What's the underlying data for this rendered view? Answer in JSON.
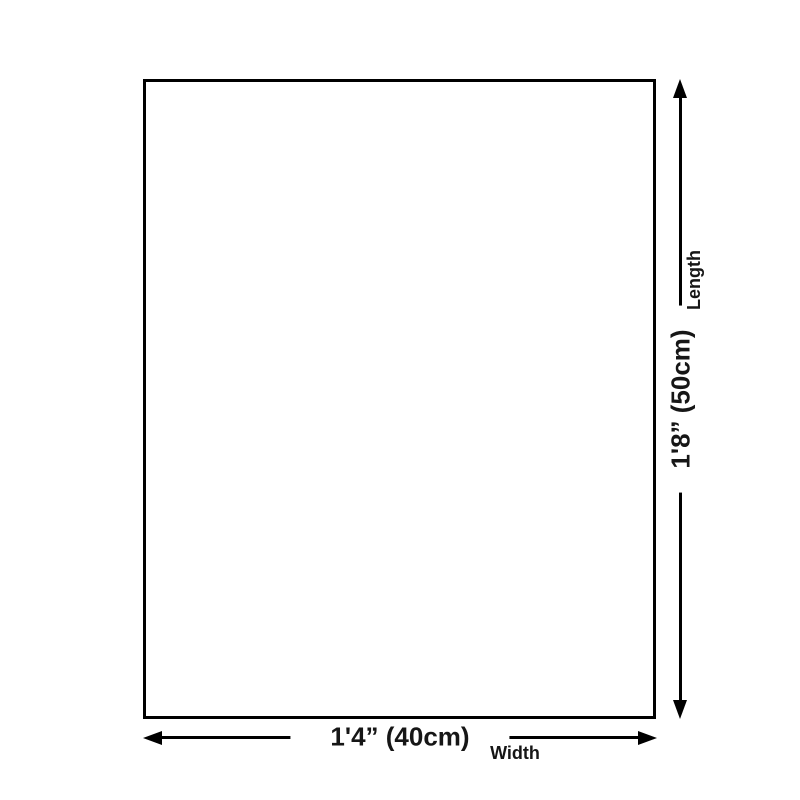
{
  "palette": {
    "background": "#ffffff",
    "line_color": "#000000",
    "text_color": "#161616"
  },
  "diagram": {
    "type": "product-size-diagram",
    "dimensions": {
      "width": {
        "value": "1'4” (40cm)",
        "name": "Width"
      },
      "length": {
        "value": "1'8” (50cm)",
        "name": "Length"
      }
    }
  }
}
